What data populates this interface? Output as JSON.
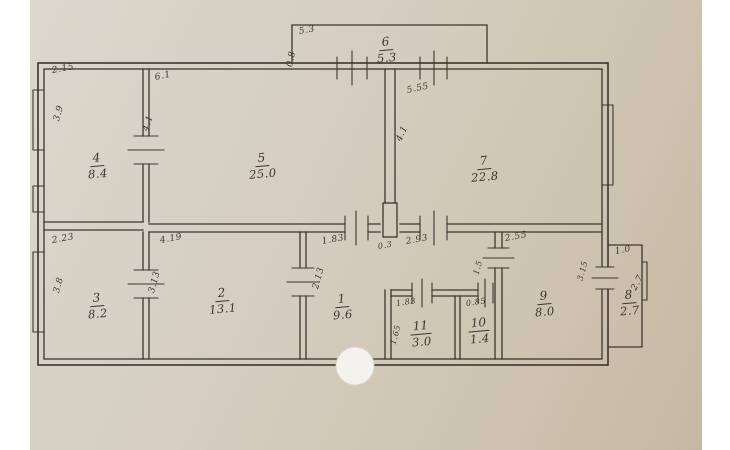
{
  "document": {
    "type": "hand-drawn apartment floor plan",
    "total_rooms_labeled": 11
  },
  "colors": {
    "paper_light": "#dcd6cc",
    "paper_dark": "#c5b8a3",
    "ink": "#3b362e",
    "hole_punch": "#f4f2ec",
    "margin": "#ffffff"
  },
  "room_labels": [
    {
      "name": "room-1",
      "number": "1",
      "area": "9.6",
      "x": 342,
      "y": 305
    },
    {
      "name": "room-2",
      "number": "2",
      "area": "13.1",
      "x": 222,
      "y": 299
    },
    {
      "name": "room-3",
      "number": "3",
      "area": "8.2",
      "x": 97,
      "y": 304
    },
    {
      "name": "room-4",
      "number": "4",
      "area": "8.4",
      "x": 97,
      "y": 164
    },
    {
      "name": "room-5",
      "number": "5",
      "area": "25.0",
      "x": 262,
      "y": 164
    },
    {
      "name": "room-6",
      "number": "6",
      "area": "5.3",
      "x": 386,
      "y": 48
    },
    {
      "name": "room-7",
      "number": "7",
      "area": "22.8",
      "x": 484,
      "y": 167
    },
    {
      "name": "room-8",
      "number": "8",
      "area": "2.7",
      "x": 629,
      "y": 301
    },
    {
      "name": "room-9",
      "number": "9",
      "area": "8.0",
      "x": 544,
      "y": 302
    },
    {
      "name": "room-10",
      "number": "10",
      "area": "1.4",
      "x": 479,
      "y": 329
    },
    {
      "name": "room-11",
      "number": "11",
      "area": "3.0",
      "x": 421,
      "y": 332
    }
  ],
  "dim_labels": [
    {
      "text": "2.15",
      "x": 52,
      "y": 66,
      "rot": -10
    },
    {
      "text": "3.9",
      "x": 57,
      "y": 116,
      "rot": -75
    },
    {
      "text": "6.1",
      "x": 155,
      "y": 73,
      "rot": -12
    },
    {
      "text": "4.1",
      "x": 146,
      "y": 126,
      "rot": -72
    },
    {
      "text": "5.3",
      "x": 299,
      "y": 27,
      "rot": -10
    },
    {
      "text": "0.8",
      "x": 290,
      "y": 62,
      "rot": -78
    },
    {
      "text": "5.55",
      "x": 407,
      "y": 86,
      "rot": -12
    },
    {
      "text": "4.1",
      "x": 399,
      "y": 136,
      "rot": -65
    },
    {
      "text": "2.23",
      "x": 52,
      "y": 236,
      "rot": -10
    },
    {
      "text": "3.8",
      "x": 57,
      "y": 288,
      "rot": -75
    },
    {
      "text": "4.19",
      "x": 160,
      "y": 236,
      "rot": -10
    },
    {
      "text": "3.13",
      "x": 152,
      "y": 288,
      "rot": -75
    },
    {
      "text": "1.83",
      "x": 322,
      "y": 237,
      "rot": -10
    },
    {
      "text": "2.13",
      "x": 316,
      "y": 284,
      "rot": -75
    },
    {
      "text": "0.3",
      "x": 378,
      "y": 242,
      "rot": -10,
      "size": "small"
    },
    {
      "text": "2.93",
      "x": 406,
      "y": 237,
      "rot": -10
    },
    {
      "text": "2.55",
      "x": 505,
      "y": 234,
      "rot": -10
    },
    {
      "text": "1.5",
      "x": 476,
      "y": 270,
      "rot": -75,
      "size": "small"
    },
    {
      "text": "3.15",
      "x": 580,
      "y": 276,
      "rot": -75,
      "size": "small"
    },
    {
      "text": "1.83",
      "x": 396,
      "y": 299,
      "rot": -8,
      "size": "small"
    },
    {
      "text": "1.65",
      "x": 393,
      "y": 340,
      "rot": -75,
      "size": "small"
    },
    {
      "text": "0.85",
      "x": 466,
      "y": 299,
      "rot": -8,
      "size": "small"
    },
    {
      "text": "1.0",
      "x": 615,
      "y": 247,
      "rot": -10
    },
    {
      "text": "2.7",
      "x": 634,
      "y": 285,
      "rot": -62
    }
  ]
}
